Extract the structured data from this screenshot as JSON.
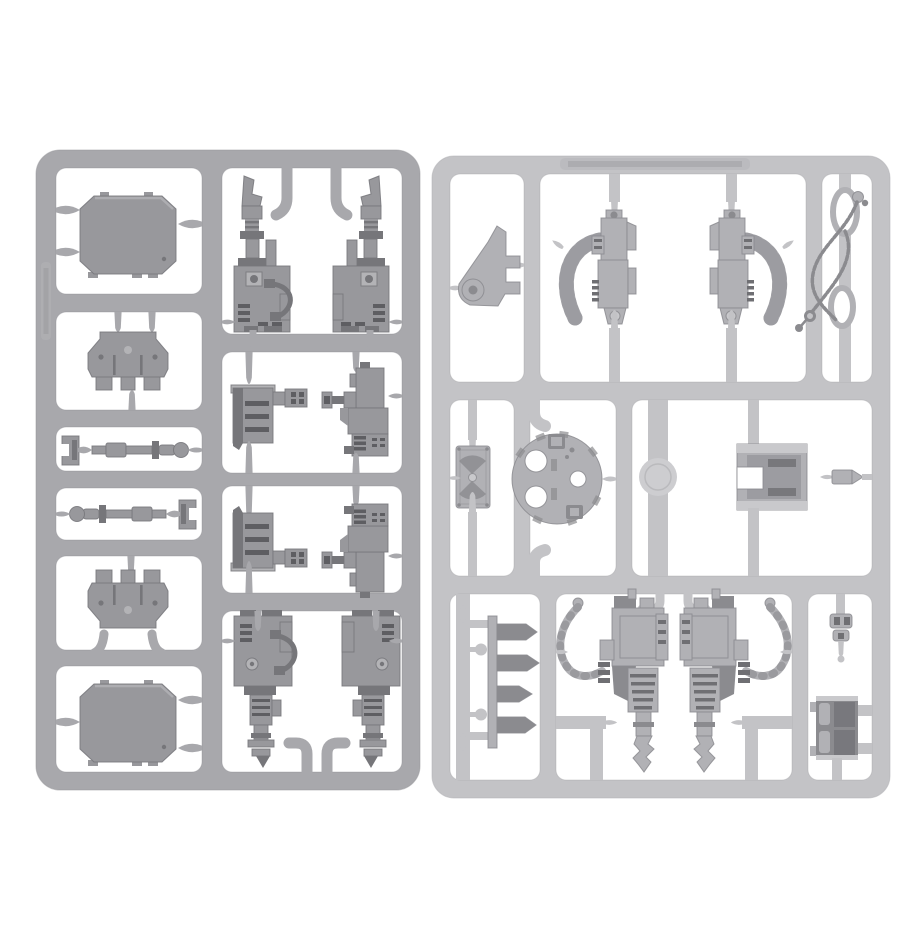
{
  "scene": {
    "description": "Product photo of two grey plastic model kit sprues (vehicle accessory frames) on a white background",
    "background": "#ffffff",
    "left_sprue_tone": "dark grey",
    "right_sprue_tone": "light grey"
  },
  "colors": {
    "bg": "#ffffff",
    "left_runner": "#a8a8ac",
    "left_runner_edge": "#939397",
    "left_part": "#98989c",
    "left_part_light": "#b3b3b6",
    "left_part_dark": "#76767a",
    "left_slot": "#5e5e62",
    "right_runner": "#c3c3c6",
    "right_runner_edge": "#aeaeb1",
    "right_part": "#b1b1b5",
    "right_part_light": "#c9c9cc",
    "right_part_dark": "#8b8b8f",
    "right_slot": "#6f6f73",
    "mould_disc": "#cdcdd0"
  },
  "left_sprue": {
    "label": "dark grey accessory sprue with hatches, armour plates and gun assemblies",
    "embossed_mark": "illegible moulded code on left rail",
    "parts": [
      {
        "name": "top-hatch",
        "desc": "rectangular vehicle hatch with chamfered corners and locating tabs"
      },
      {
        "name": "armour-plate-upper",
        "desc": "trapezoidal armour plate, ribs facing down"
      },
      {
        "name": "clamp-and-rod-upper",
        "desc": "small mounting clamp with segmented towing rod"
      },
      {
        "name": "rod-and-clamp-lower",
        "desc": "mirrored segmented rod with small clamp"
      },
      {
        "name": "armour-plate-lower",
        "desc": "trapezoidal armour plate, ribs facing up"
      },
      {
        "name": "bottom-hatch",
        "desc": "second rectangular vehicle hatch"
      },
      {
        "name": "heavy-gun-up-left",
        "desc": "heavy weapon pointing up with ammo hose"
      },
      {
        "name": "heavy-gun-up-right",
        "desc": "mirrored heavy weapon pointing up"
      },
      {
        "name": "ammo-box-upper",
        "desc": "ribbed ammunition box with side bolter"
      },
      {
        "name": "compact-gun-upper",
        "desc": "compact boxy weapon with left barrel cluster"
      },
      {
        "name": "ammo-box-lower",
        "desc": "mirrored ribbed ammunition box"
      },
      {
        "name": "compact-gun-lower",
        "desc": "mirrored compact boxy weapon"
      },
      {
        "name": "heavy-gun-down-left",
        "desc": "heavy weapon pointing down with hose"
      },
      {
        "name": "heavy-gun-down-right",
        "desc": "mirrored heavy weapon pointing down"
      }
    ]
  },
  "right_sprue": {
    "label": "light grey accessory sprue with turret hatch, belt-fed guns, chains, drills and stowage",
    "embossed_mark": "illegible moulded lettering on top rail",
    "parts": [
      {
        "name": "hinge-bracket-fin",
        "desc": "triangular hinge bracket with cylinder boss"
      },
      {
        "name": "belt-fed-gun-left",
        "desc": "vertical gun with curved ammo belt on left"
      },
      {
        "name": "belt-fed-gun-right",
        "desc": "mirrored vertical gun with curved ammo belt"
      },
      {
        "name": "chain-with-rings",
        "desc": "length of chain with two oval rings and hook"
      },
      {
        "name": "icon-plaque",
        "desc": "small rectangular plaque with eagle emblem"
      },
      {
        "name": "round-turret-hatch",
        "desc": "circular turret hatch ring with cut-outs"
      },
      {
        "name": "mould-disc",
        "desc": "faint circular mould stamp on runner"
      },
      {
        "name": "housing-box",
        "desc": "boxy housing with notched opening"
      },
      {
        "name": "shell-round",
        "desc": "small pointed shell round"
      },
      {
        "name": "spiked-blade-rack",
        "desc": "rack of four spiked blades on runner"
      },
      {
        "name": "drill-gun-left",
        "desc": "drill weapon with coiled cable, bit pointing down"
      },
      {
        "name": "drill-gun-right",
        "desc": "mirrored drill weapon with coiled cable"
      },
      {
        "name": "small-bracket-clip",
        "desc": "tiny bracket clip"
      },
      {
        "name": "storage-crate",
        "desc": "panelled storage crate"
      }
    ]
  }
}
